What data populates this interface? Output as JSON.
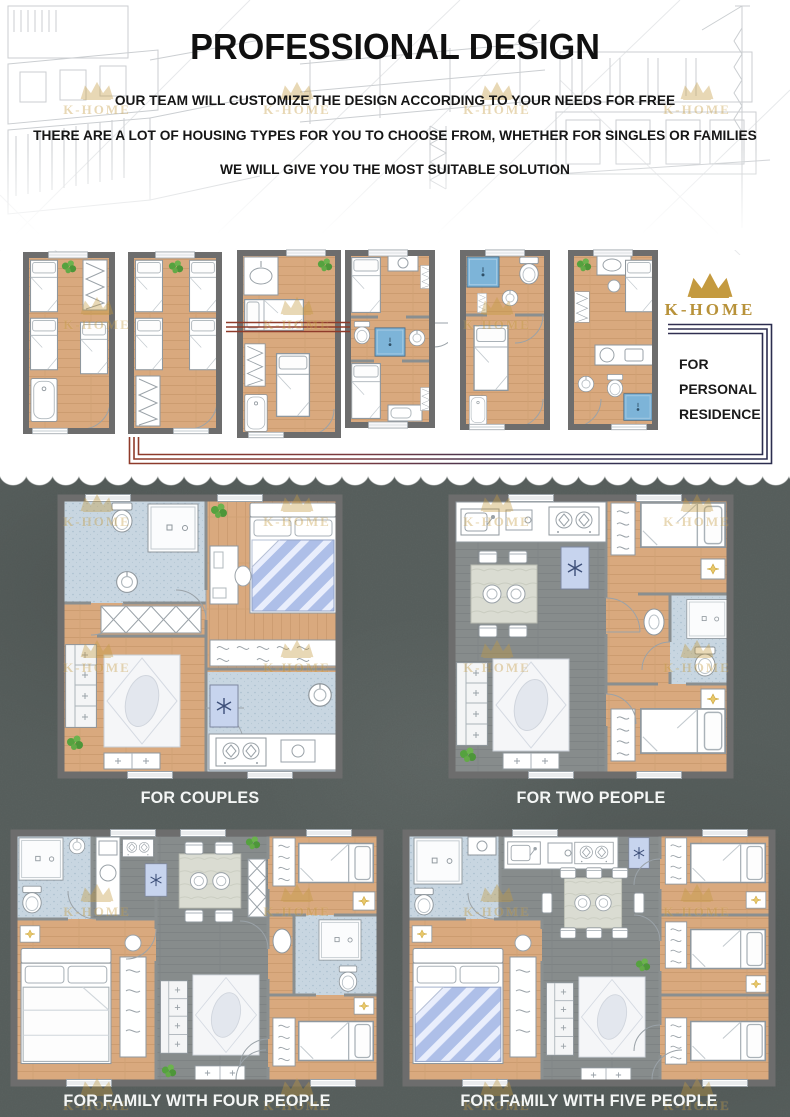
{
  "brand": {
    "name": "K-HOME",
    "logo_color": "#c49a3f"
  },
  "hero": {
    "title": "PROFESSIONAL DESIGN",
    "subtitle_lines": [
      "OUR TEAM WILL CUSTOMIZE THE DESIGN ACCORDING TO YOUR NEEDS FOR FREE",
      "THERE ARE A LOT OF HOUSING TYPES FOR YOU TO CHOOSE FROM, WHETHER FOR SINGLES OR FAMILIES",
      "WE WILL GIVE YOU THE MOST SUITABLE SOLUTION"
    ]
  },
  "personal_residence": {
    "lines": [
      "FOR",
      "PERSONAL",
      "RESIDENCE"
    ]
  },
  "floor_plan_captions": {
    "couples": "FOR COUPLES",
    "two_people": "FOR TWO PEOPLE",
    "family_four": "FOR FAMILY WITH FOUR PEOPLE",
    "family_five": "FOR FAMILY WITH FIVE PEOPLE"
  },
  "palette": {
    "wood_floor": "#d9a97e",
    "tile_floor": "#c8d6e1",
    "gray_floor": "#878c8c",
    "wall_gray": "#6d6d6d",
    "shower_blue": "#7db4d8",
    "bed_blue": "#aebfe8",
    "accent_red": "#8f3b2a",
    "accent_navy": "#2b2d4f",
    "background_dark": "#5c6462",
    "accent_gold": "#c49a3f"
  }
}
